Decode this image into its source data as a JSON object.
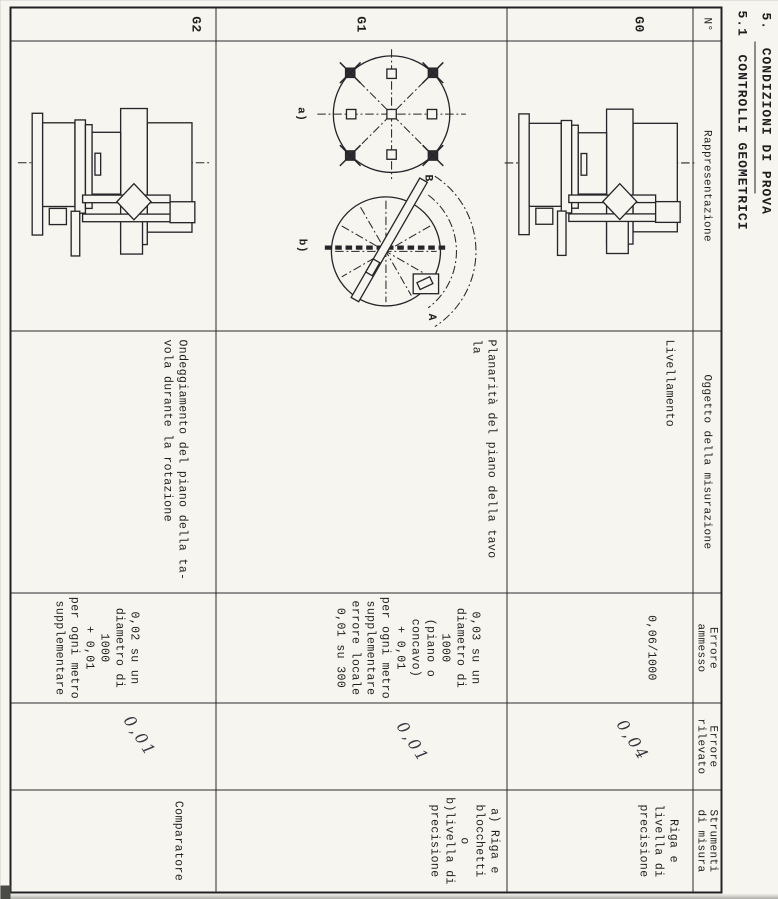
{
  "page": {
    "heading1": "5.  CONDIZIONI DI PROVA",
    "heading2": "5.1  CONTROLLI GEOMETRICI"
  },
  "colors": {
    "paper": "#f6f5f0",
    "ink": "#1e1e1e",
    "pencil": "#36363e"
  },
  "table": {
    "headers": [
      {
        "lines": [
          "N°"
        ]
      },
      {
        "lines": [
          "Rappresentazione"
        ]
      },
      {
        "lines": [
          "Oggetto della misurazione"
        ]
      },
      {
        "lines": [
          "Errore",
          "ammesso"
        ]
      },
      {
        "lines": [
          "Errore",
          "rilevato"
        ]
      },
      {
        "lines": [
          "Strumenti",
          "di misura"
        ]
      }
    ],
    "rows": [
      {
        "id": "G0",
        "object_lines": [
          "Livellamento"
        ],
        "allowed_lines": [
          "0,06/1000"
        ],
        "measured": "0,04",
        "instrument_lines": [
          "Riga e",
          "livella di",
          "precisione"
        ],
        "drawing": "machine side view"
      },
      {
        "id": "G1",
        "object_lines": [
          "Planarità del piano della tavo",
          "la"
        ],
        "allowed_lines": [
          "0,03 su un",
          "diametro di",
          "1000",
          "(piano o",
          "concavo)",
          "+ 0,01",
          "per ogni metro",
          "supplementare",
          "errore locale",
          "0,01 su 300"
        ],
        "measured": "0,01",
        "instrument_lines": [
          "a) Riga e",
          "blocchetti",
          "o",
          "b)livella di",
          "precisione"
        ],
        "drawing": "flatness check diagrams",
        "labels": {
          "a": "a)",
          "b": "b)",
          "A": "A",
          "B": "B"
        }
      },
      {
        "id": "G2",
        "object_lines": [
          "Ondeggiamento del piano della ta-",
          "vola durante la rotazione"
        ],
        "allowed_lines": [
          "0,02 su un",
          "diametro di",
          "1000",
          "+ 0,01",
          "per ogni metro",
          "supplementare"
        ],
        "measured": "0,01",
        "instrument_lines": [
          "Comparatore"
        ],
        "drawing": "machine side view"
      }
    ]
  }
}
